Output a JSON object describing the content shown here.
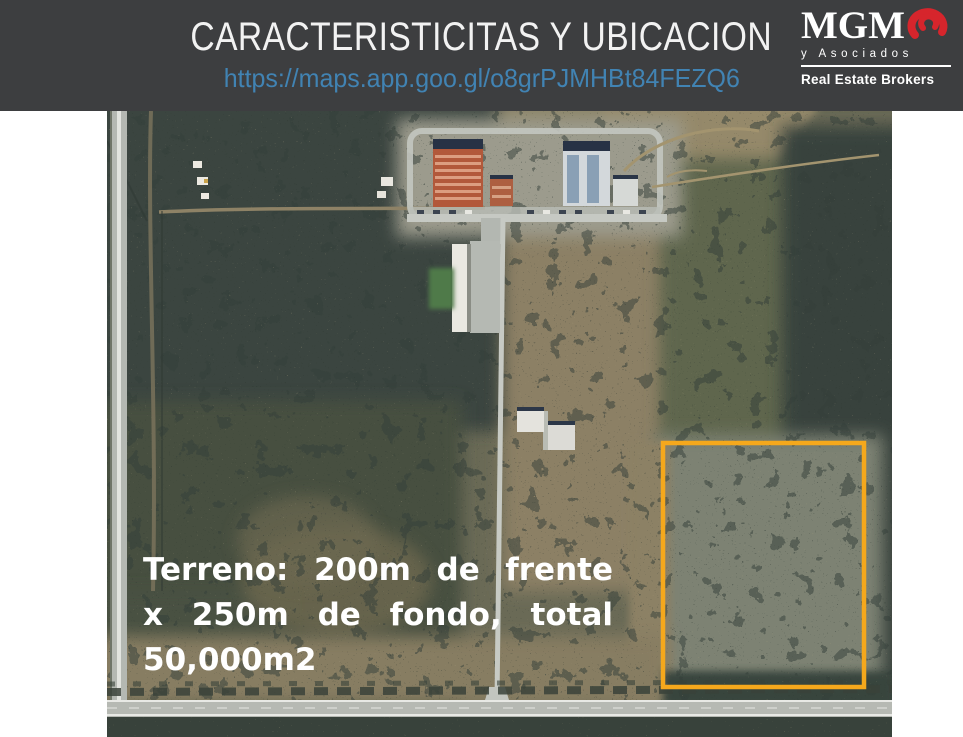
{
  "header": {
    "title": "CARACTERISTICITAS Y UBICACION",
    "link": "https://maps.app.goo.gl/o8grPJMHBt84FEZQ6",
    "background_color": "#3d3e40",
    "title_color": "#f2f2f2",
    "link_color": "#4183b3",
    "logo": {
      "name": "MGM",
      "subtitle": "y Asociados",
      "tagline": "Real Estate Brokers",
      "accent_color": "#d6252c",
      "text_color": "#ffffff",
      "swirl_icon": "red-spiral-g-mark"
    }
  },
  "map": {
    "type": "satellite-aerial-view",
    "parcel": {
      "outline_color": "#f5a81c",
      "shape": "rectangle",
      "location": "right-lower-area"
    },
    "overlay": {
      "lines": [
        "Terreno: 200m de frente",
        "x 250m de fondo, total",
        "50,000m2"
      ],
      "full_text": "Terreno: 200m de frente x 250m de fondo, total 50,000m2",
      "text_color": "#ffffff"
    }
  }
}
